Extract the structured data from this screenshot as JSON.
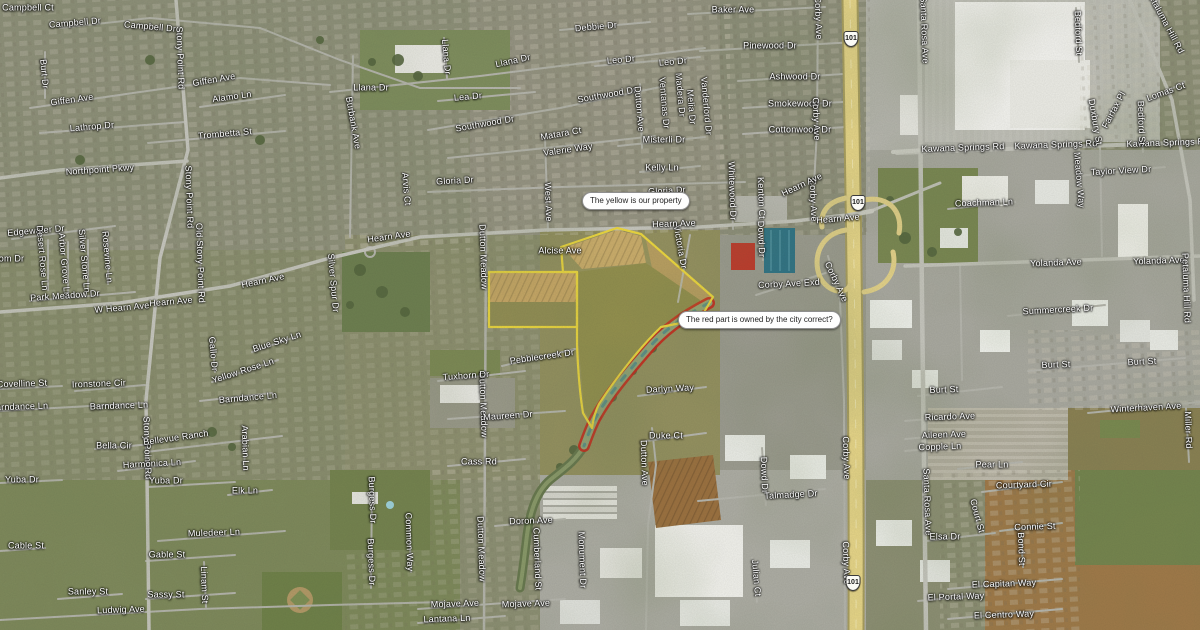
{
  "map": {
    "callouts": [
      {
        "text": "The yellow is our property",
        "x": 582,
        "y": 192
      },
      {
        "text": "The red part is owned by the city correct?",
        "x": 678,
        "y": 311
      }
    ],
    "highway_shields": [
      {
        "label": "101",
        "x": 851,
        "y": 39
      },
      {
        "label": "101",
        "x": 858,
        "y": 203
      },
      {
        "label": "101",
        "x": 853,
        "y": 583
      }
    ],
    "colors": {
      "property_outline": "#ecd73f",
      "city_parcel_outline": "#c8281c",
      "freeway": "#e6d588",
      "road": "#bdbdb5"
    },
    "street_labels": [
      [
        "Campbell Ct",
        28,
        8,
        0
      ],
      [
        "Campbell Dr",
        75,
        23,
        -5
      ],
      [
        "Campbell Dr",
        150,
        27,
        5
      ],
      [
        "Stony Point Rd",
        180,
        58,
        88
      ],
      [
        "Burt Dr",
        44,
        74,
        85
      ],
      [
        "Giffen Ave",
        72,
        100,
        -8
      ],
      [
        "Giffen Ave",
        214,
        80,
        -10
      ],
      [
        "Alamo Ln",
        232,
        97,
        -8
      ],
      [
        "Lathrop Dr",
        92,
        127,
        -5
      ],
      [
        "Trombetta St",
        225,
        134,
        -5
      ],
      [
        "Llana Dr",
        371,
        88,
        0
      ],
      [
        "Llana Dr",
        513,
        61,
        -12
      ],
      [
        "Llana Dr",
        446,
        57,
        85
      ],
      [
        "Lea Dr",
        468,
        97,
        -5
      ],
      [
        "Southwood Dr",
        485,
        124,
        -10
      ],
      [
        "Southwood Dr",
        607,
        95,
        -10
      ],
      [
        "Valerie Way",
        568,
        150,
        -8
      ],
      [
        "Matara Ct",
        561,
        134,
        -10
      ],
      [
        "Leo Dr",
        621,
        60,
        -5
      ],
      [
        "Leo Dr",
        673,
        62,
        -5
      ],
      [
        "Debbie Dr",
        596,
        27,
        -5
      ],
      [
        "Misterli Dr",
        664,
        140,
        0
      ],
      [
        "Kelly Ln",
        662,
        168,
        0
      ],
      [
        "Ventanas Dr",
        664,
        103,
        85
      ],
      [
        "Madera Dr",
        680,
        95,
        85
      ],
      [
        "Melia Dr",
        691,
        107,
        85
      ],
      [
        "Vanderford Dr",
        706,
        106,
        85
      ],
      [
        "Dutton Ave",
        639,
        109,
        85
      ],
      [
        "Burbank Ave",
        353,
        123,
        80
      ],
      [
        "West Ave",
        548,
        202,
        88
      ],
      [
        "Baker Ave",
        733,
        10,
        0
      ],
      [
        "Pinewood Dr",
        770,
        46,
        0
      ],
      [
        "Ashwood Dr",
        795,
        77,
        0
      ],
      [
        "Smokewood Dr",
        800,
        104,
        0
      ],
      [
        "Cottonwood Dr",
        800,
        130,
        0
      ],
      [
        "Corby Ave",
        818,
        18,
        88
      ],
      [
        "Corby Ave",
        816,
        119,
        88
      ],
      [
        "Corby Ave",
        813,
        200,
        88
      ],
      [
        "Corby Ave",
        836,
        282,
        65
      ],
      [
        "Corby Ave",
        846,
        458,
        88
      ],
      [
        "Corby Ave",
        846,
        563,
        88
      ],
      [
        "Corby Ave Exd",
        789,
        284,
        -3
      ],
      [
        "Whitewood Dr",
        732,
        191,
        88
      ],
      [
        "Kenton Ct",
        761,
        198,
        88
      ],
      [
        "Dowd Dr",
        761,
        239,
        88
      ],
      [
        "Dowd Dr",
        764,
        475,
        88
      ],
      [
        "Victoria Dr",
        680,
        247,
        80
      ],
      [
        "Gloria Dr",
        455,
        181,
        -3
      ],
      [
        "Gloria Dr",
        667,
        191,
        -3
      ],
      [
        "W Hearn Ave",
        122,
        308,
        -5
      ],
      [
        "Hearn Ave",
        171,
        302,
        -5
      ],
      [
        "Hearn Ave",
        263,
        281,
        -12
      ],
      [
        "Hearn Ave",
        389,
        237,
        -8
      ],
      [
        "Hearn Ave",
        674,
        224,
        -2
      ],
      [
        "Hearn Ave",
        802,
        185,
        -25
      ],
      [
        "Hearn Ave",
        838,
        219,
        -5
      ],
      [
        "Northpoint Pkwy",
        100,
        170,
        -4
      ],
      [
        "Edgewater Dr",
        36,
        231,
        -5
      ],
      [
        "Blossom Dr",
        0,
        259,
        0
      ],
      [
        "Desert Rose Ln",
        42,
        258,
        85
      ],
      [
        "Arbor Grove Ln",
        64,
        265,
        85
      ],
      [
        "Silver Stone Ln",
        84,
        261,
        85
      ],
      [
        "Rosevine Ln",
        107,
        257,
        85
      ],
      [
        "Park Meadow Dr",
        65,
        296,
        -4
      ],
      [
        "Old Stony Point Rd",
        200,
        263,
        88
      ],
      [
        "Stony Point Rd",
        189,
        197,
        88
      ],
      [
        "Stony Point Rd",
        147,
        448,
        88
      ],
      [
        "Silver Spur Dr",
        333,
        283,
        85
      ],
      [
        "Arvis Ct",
        406,
        189,
        85
      ],
      [
        "Dutton Meadow",
        483,
        257,
        88
      ],
      [
        "Dutton Meadow",
        483,
        405,
        88
      ],
      [
        "Dutton Meadow",
        481,
        549,
        88
      ],
      [
        "Alcise Ave",
        560,
        251,
        0
      ],
      [
        "Pebblecreek Dr",
        542,
        357,
        -8
      ],
      [
        "Tuxhorn Dr",
        466,
        376,
        -4
      ],
      [
        "Maureen Dr",
        508,
        416,
        -4
      ],
      [
        "Cass Rd",
        479,
        462,
        0
      ],
      [
        "Doron Ave",
        531,
        521,
        -2
      ],
      [
        "Darlyn Way",
        670,
        389,
        -3
      ],
      [
        "Duke Ct",
        666,
        436,
        0
      ],
      [
        "Dutton Ave",
        644,
        463,
        88
      ],
      [
        "Talmadge Dr",
        791,
        495,
        -3
      ],
      [
        "Julian Ct",
        756,
        578,
        85
      ],
      [
        "Cumberland St",
        537,
        559,
        88
      ],
      [
        "Monument Dr",
        582,
        560,
        88
      ],
      [
        "Common Way",
        409,
        542,
        88
      ],
      [
        "Burgess Dr",
        372,
        500,
        88
      ],
      [
        "Burgess Dr",
        371,
        562,
        88
      ],
      [
        "Mojave Ave",
        455,
        604,
        -2
      ],
      [
        "Mojave Ave",
        526,
        604,
        -2
      ],
      [
        "Lantana Ln",
        447,
        619,
        -2
      ],
      [
        "Covelline St",
        22,
        384,
        -2
      ],
      [
        "Ironstone Cir",
        99,
        384,
        -2
      ],
      [
        "Barndance Ln",
        19,
        407,
        -2
      ],
      [
        "Barndance Ln",
        119,
        406,
        -2
      ],
      [
        "Barndance Ln",
        248,
        398,
        -5
      ],
      [
        "Bella Cir",
        114,
        446,
        0
      ],
      [
        "Harmonica Ln",
        152,
        464,
        -3
      ],
      [
        "Bellevue Ranch",
        176,
        438,
        -8
      ],
      [
        "Yellow Rose Ln",
        243,
        371,
        -18
      ],
      [
        "Blue Sky Ln",
        277,
        342,
        -18
      ],
      [
        "Gallo Dr",
        213,
        354,
        85
      ],
      [
        "Arabian Ln",
        245,
        448,
        88
      ],
      [
        "Yuba Dr",
        22,
        480,
        0
      ],
      [
        "Yuba Dr",
        166,
        481,
        0
      ],
      [
        "Elk Ln",
        245,
        491,
        0
      ],
      [
        "Muledeer Ln",
        214,
        533,
        -2
      ],
      [
        "Gable St",
        167,
        555,
        0
      ],
      [
        "Sassy St",
        166,
        595,
        0
      ],
      [
        "Linam St",
        204,
        585,
        88
      ],
      [
        "Ludwig Ave",
        121,
        610,
        -2
      ],
      [
        "Cable St",
        26,
        546,
        0
      ],
      [
        "Sanley St",
        88,
        592,
        0
      ],
      [
        "Santa Rosa Ave",
        924,
        30,
        88
      ],
      [
        "Santa Rosa Ave",
        927,
        502,
        88
      ],
      [
        "Kawana Springs Rd",
        963,
        148,
        -2
      ],
      [
        "Kawana Springs Rd",
        1056,
        145,
        -2
      ],
      [
        "Kawana Springs Rd",
        1168,
        143,
        -2
      ],
      [
        "Coachman Ln",
        984,
        203,
        -2
      ],
      [
        "Taylor View Dr",
        1121,
        171,
        -3
      ],
      [
        "Yolanda Ave",
        1056,
        263,
        -2
      ],
      [
        "Yolanda Ave",
        1159,
        261,
        -2
      ],
      [
        "Summercreek Dr",
        1058,
        310,
        -3
      ],
      [
        "Burt St",
        944,
        390,
        -2
      ],
      [
        "Burt St",
        1056,
        365,
        -2
      ],
      [
        "Burt St",
        1142,
        362,
        -3
      ],
      [
        "Winterhaven Ave",
        1146,
        408,
        -3
      ],
      [
        "Ricardo Ave",
        950,
        417,
        -2
      ],
      [
        "Aileen Ave",
        944,
        435,
        -2
      ],
      [
        "Copple Ln",
        940,
        447,
        -2
      ],
      [
        "Pear Ln",
        992,
        465,
        0
      ],
      [
        "Miller Rd",
        1188,
        430,
        88
      ],
      [
        "Petaluma Hill Rd",
        1165,
        22,
        62
      ],
      [
        "Petaluma Hill Rd",
        1186,
        288,
        88
      ],
      [
        "Bedford St",
        1078,
        33,
        88
      ],
      [
        "Bedford St",
        1141,
        123,
        88
      ],
      [
        "Fairfax Pl",
        1114,
        110,
        -62
      ],
      [
        "Lomas Ct",
        1166,
        92,
        -20
      ],
      [
        "Duxbury St",
        1095,
        122,
        80
      ],
      [
        "Meadow Way",
        1079,
        180,
        85
      ],
      [
        "Elsa Dr",
        945,
        537,
        0
      ],
      [
        "Courtyard Cir",
        1024,
        485,
        -2
      ],
      [
        "Connie St",
        1035,
        527,
        -2
      ],
      [
        "Bond St",
        1021,
        549,
        88
      ],
      [
        "Court St",
        977,
        516,
        75
      ],
      [
        "El Capitan Way",
        1004,
        584,
        -2
      ],
      [
        "El Portal Way",
        956,
        597,
        -2
      ],
      [
        "El Centro Way",
        1004,
        615,
        -2
      ]
    ]
  }
}
